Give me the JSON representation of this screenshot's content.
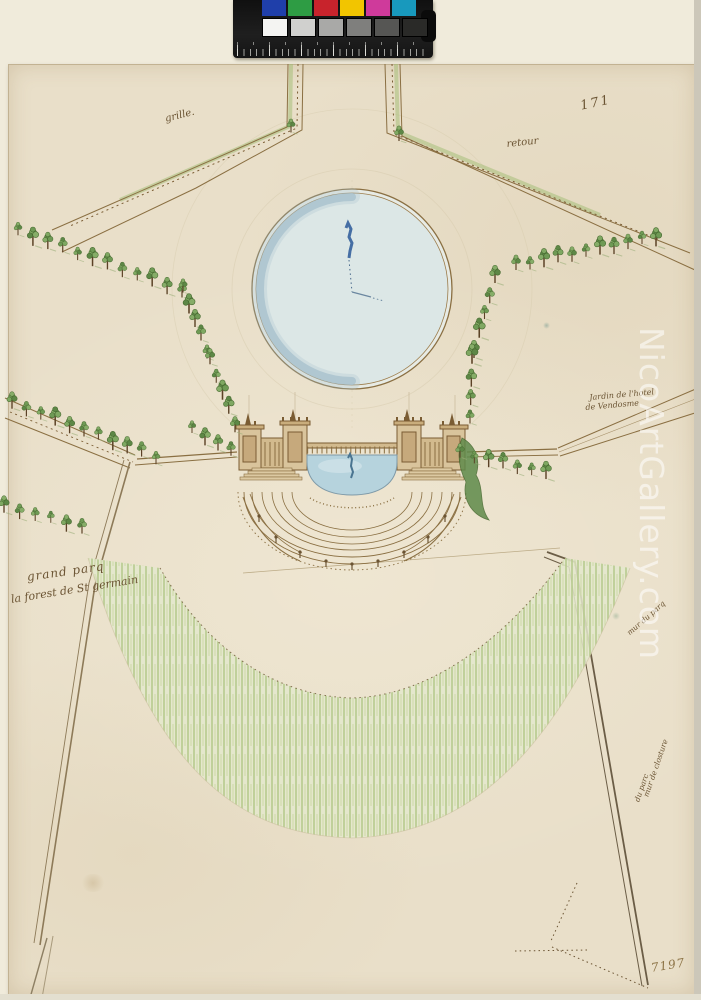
{
  "artwork": {
    "description": "Plan and elevation drawing of a garden terrace with round basin, tree-lined avenues and sloping glacis",
    "inscriptions": {
      "folio_number": "171",
      "gate_label": "grille.",
      "return_label": "retour",
      "garden_line1": "Jardin de l'hotel",
      "garden_line2": "de Vendosme",
      "park_line1": "grand parq",
      "park_line2": "la forest de St germain",
      "wall_label_upper": "mur du parq",
      "wall_label_lower1": "mur de closture",
      "wall_label_lower2": "du parc",
      "inventory_number": "7197"
    }
  },
  "watermark": {
    "text": "NicoArtGallery.com"
  },
  "color_chart": {
    "color_swatches": [
      "#1f3faa",
      "#2e9c44",
      "#c8232c",
      "#f2c500",
      "#cf3a9b",
      "#1899bd"
    ],
    "gray_swatches": [
      "#f4f4f2",
      "#d0d0ce",
      "#a9a9a7",
      "#7f7f7d",
      "#565654",
      "#2a2a28"
    ]
  },
  "palette": {
    "background": "#f0ebdb",
    "paper": "#e9dfc9",
    "ink": "#7a5c33",
    "tree_green": "#6f9a55",
    "meadow_green": "#c5d49b",
    "pond_blue": "#dce7e6",
    "pond_rim_blue": "#a9c2cd",
    "basin_blue": "#b6d3dd",
    "watermark_color": "rgba(255,255,255,0.55)"
  },
  "scene": {
    "tree_rows": [
      {
        "x1": 18,
        "y1": 232,
        "x2": 182,
        "y2": 292,
        "n": 12,
        "s": 1
      },
      {
        "x1": 516,
        "y1": 266,
        "x2": 656,
        "y2": 238,
        "n": 11,
        "s": 1
      },
      {
        "x1": 12,
        "y1": 404,
        "x2": 156,
        "y2": 458,
        "n": 11,
        "s": 1
      },
      {
        "x1": 4,
        "y1": 508,
        "x2": 82,
        "y2": 528,
        "n": 6,
        "s": 0.9
      },
      {
        "x1": 183,
        "y1": 289,
        "x2": 207,
        "y2": 352,
        "n": 5,
        "s": 1.05
      },
      {
        "x1": 210,
        "y1": 360,
        "x2": 235,
        "y2": 425,
        "n": 5,
        "s": 1.05
      },
      {
        "x1": 495,
        "y1": 278,
        "x2": 474,
        "y2": 350,
        "n": 5,
        "s": 1.05
      },
      {
        "x1": 472,
        "y1": 358,
        "x2": 470,
        "y2": 420,
        "n": 4,
        "s": 1.05
      },
      {
        "x1": 192,
        "y1": 430,
        "x2": 231,
        "y2": 452,
        "n": 4,
        "s": 0.95
      },
      {
        "x1": 460,
        "y1": 454,
        "x2": 546,
        "y2": 474,
        "n": 7,
        "s": 0.95
      },
      {
        "x1": 291,
        "y1": 129,
        "x2": 291,
        "y2": 129,
        "n": 1,
        "s": 0.8
      },
      {
        "x1": 399,
        "y1": 137,
        "x2": 399,
        "y2": 137,
        "n": 1,
        "s": 0.8
      }
    ]
  }
}
